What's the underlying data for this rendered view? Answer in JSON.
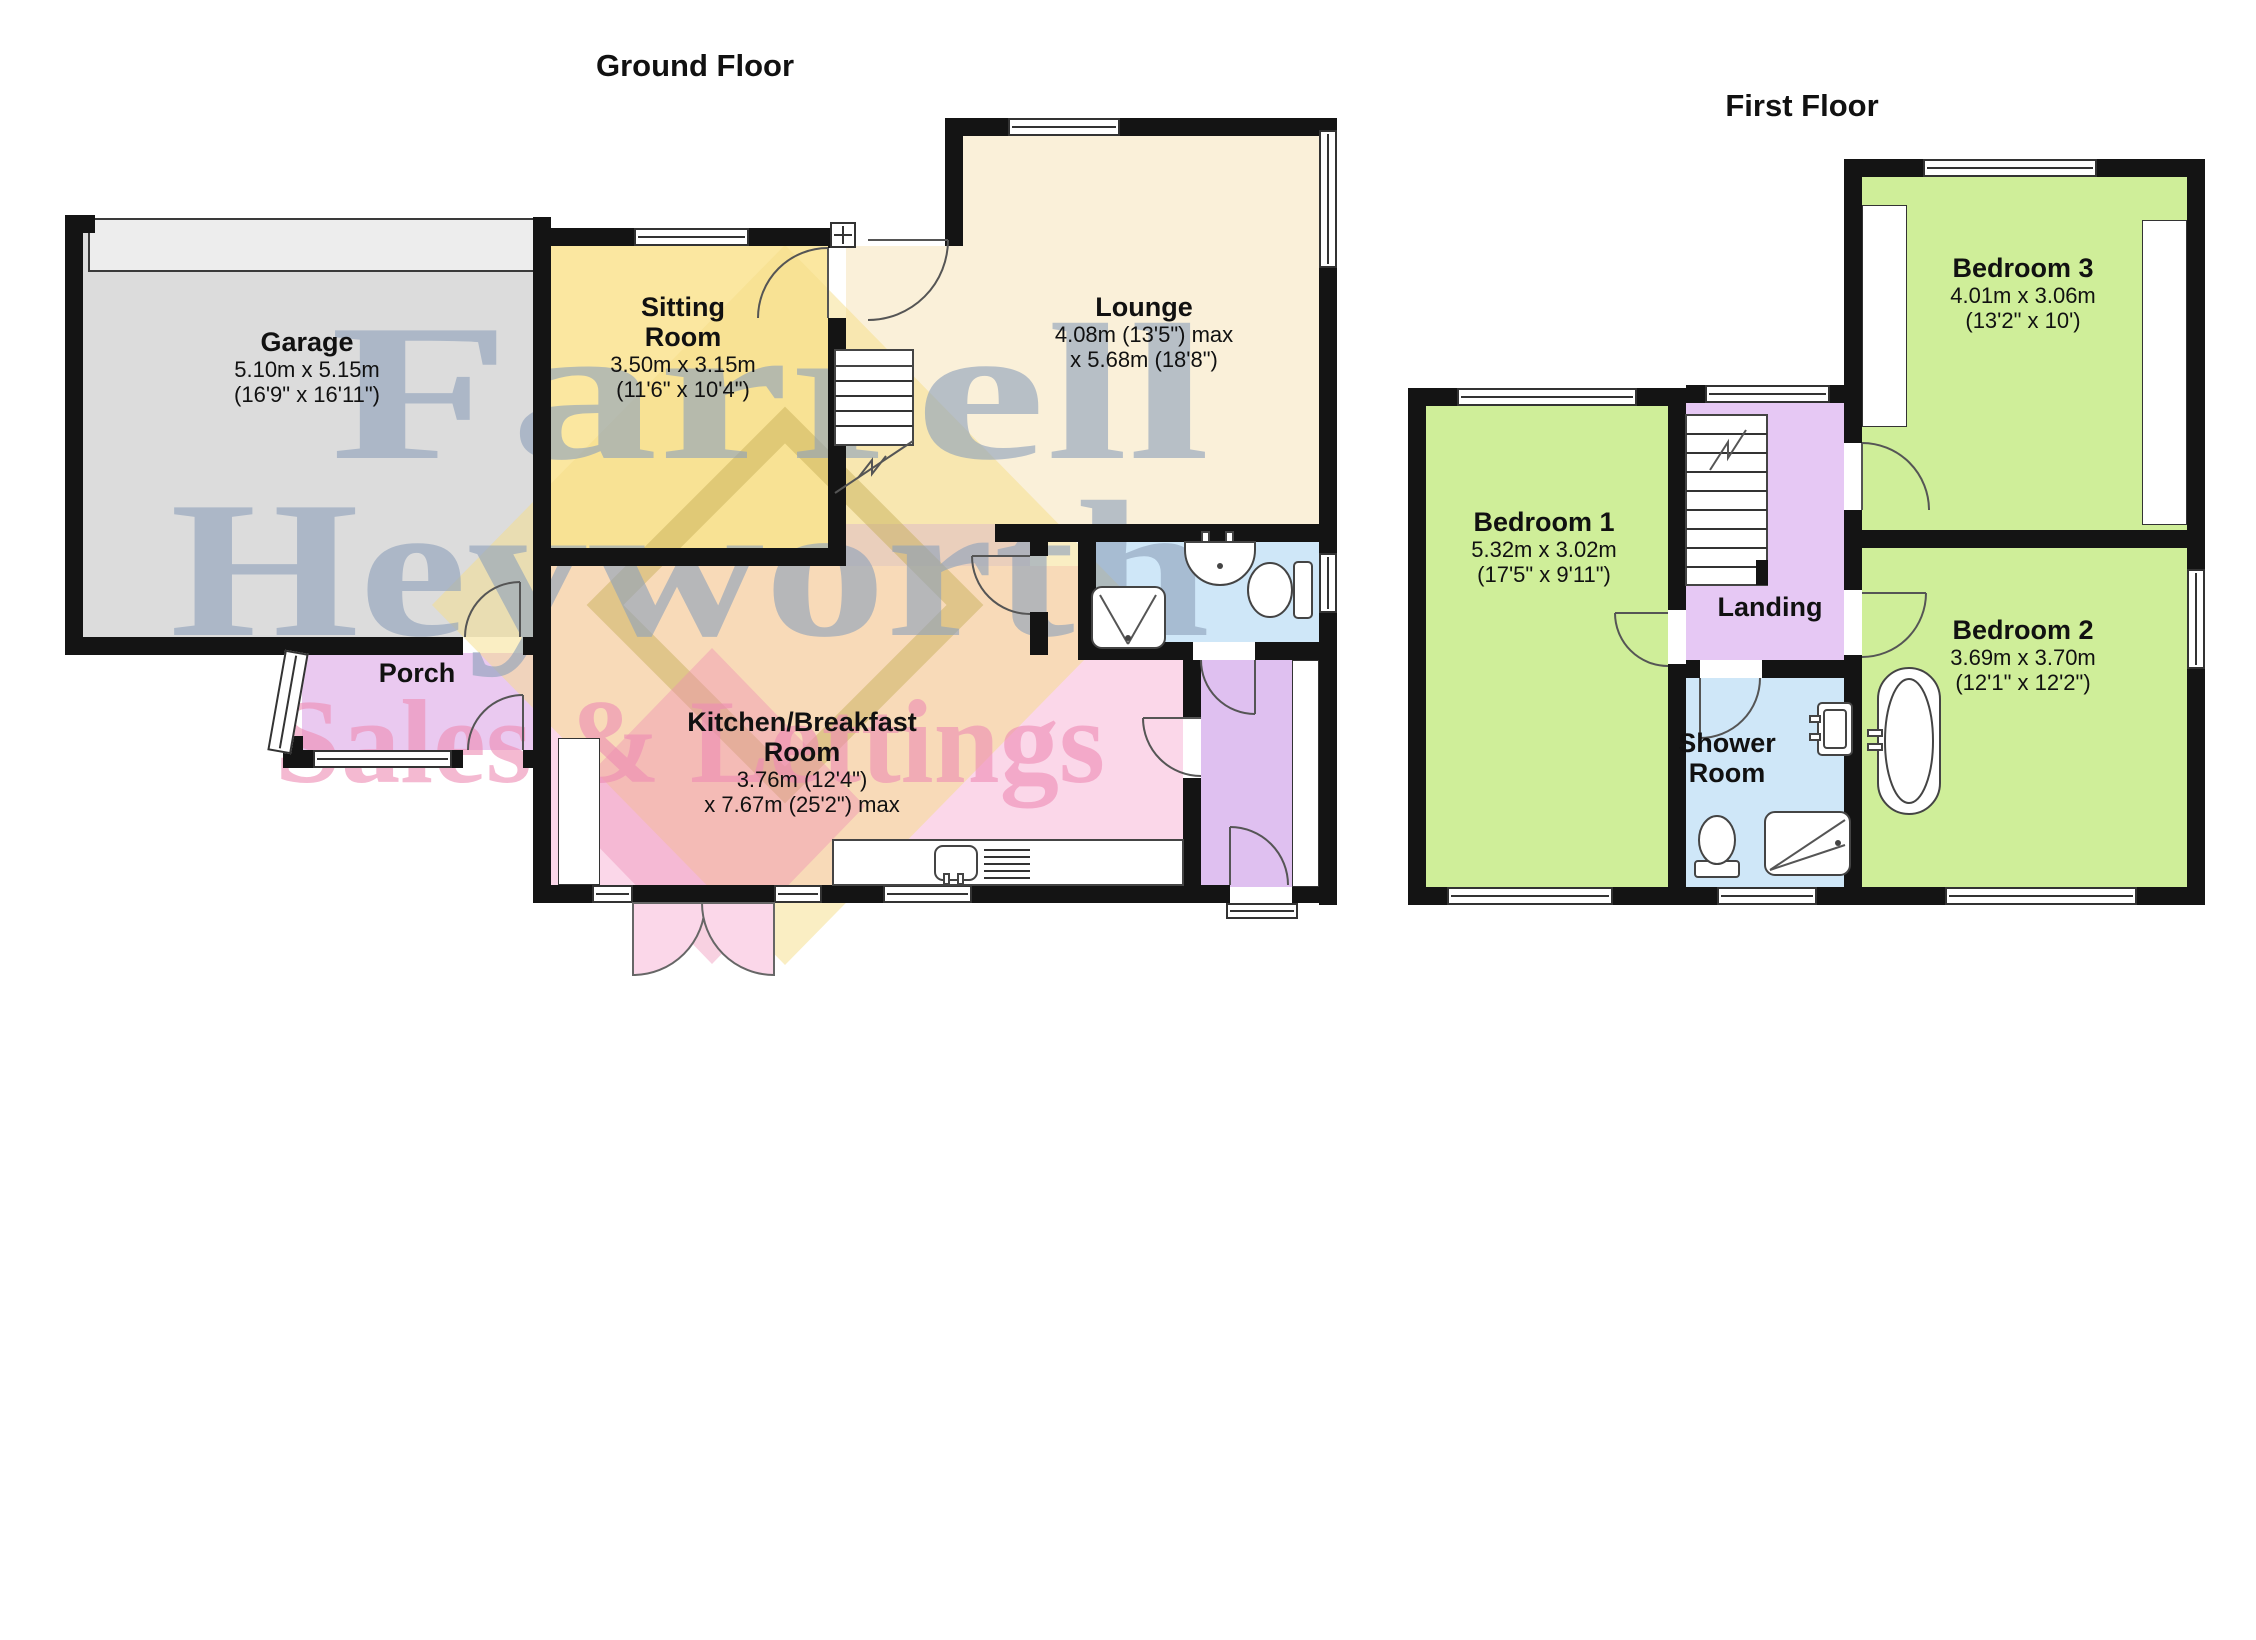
{
  "watermark": {
    "line1": "Farrell",
    "line2": "Heyworth",
    "line3": "Sales & Lettings"
  },
  "colors": {
    "wall": "#141414",
    "garage": "#dcdcdc",
    "garage_door": "#ededed",
    "sitting": "#fbe7a0",
    "lounge": "#faf0d9",
    "kitchen": "#fbd7e9",
    "hall": "#dfc0f0",
    "porch": "#eac9f0",
    "landing": "#e6c8f4",
    "bath": "#cfe7f8",
    "bedroom": "#cfee99",
    "wm_blue": "#8fa2bb",
    "wm_pink": "#ee8cb4",
    "wm_yellow": "#f6dd88"
  },
  "ground_floor": {
    "title": "Ground Floor",
    "rooms": {
      "garage": {
        "name_lines": [
          "Garage"
        ],
        "dims": [
          "5.10m x 5.15m",
          "(16'9\" x 16'11\")"
        ]
      },
      "sitting": {
        "name_lines": [
          "Sitting",
          "Room"
        ],
        "dims": [
          "3.50m x 3.15m",
          "(11'6\" x 10'4\")"
        ]
      },
      "lounge": {
        "name_lines": [
          "Lounge"
        ],
        "dims": [
          "4.08m (13'5\") max",
          "x 5.68m (18'8\")"
        ]
      },
      "porch": {
        "name_lines": [
          "Porch"
        ],
        "dims": []
      },
      "kitchen": {
        "name_lines": [
          "Kitchen/Breakfast",
          "Room"
        ],
        "dims": [
          "3.76m (12'4\")",
          "x 7.67m (25'2\") max"
        ]
      }
    }
  },
  "first_floor": {
    "title": "First Floor",
    "rooms": {
      "bedroom3": {
        "name_lines": [
          "Bedroom 3"
        ],
        "dims": [
          "4.01m x 3.06m",
          "(13'2\" x 10')"
        ]
      },
      "bedroom1": {
        "name_lines": [
          "Bedroom 1"
        ],
        "dims": [
          "5.32m x 3.02m",
          "(17'5\" x 9'11\")"
        ]
      },
      "landing": {
        "name_lines": [
          "Landing"
        ],
        "dims": []
      },
      "bedroom2": {
        "name_lines": [
          "Bedroom 2"
        ],
        "dims": [
          "3.69m x 3.70m",
          "(12'1\" x 12'2\")"
        ]
      },
      "shower": {
        "name_lines": [
          "Shower",
          "Room"
        ],
        "dims": []
      }
    }
  }
}
